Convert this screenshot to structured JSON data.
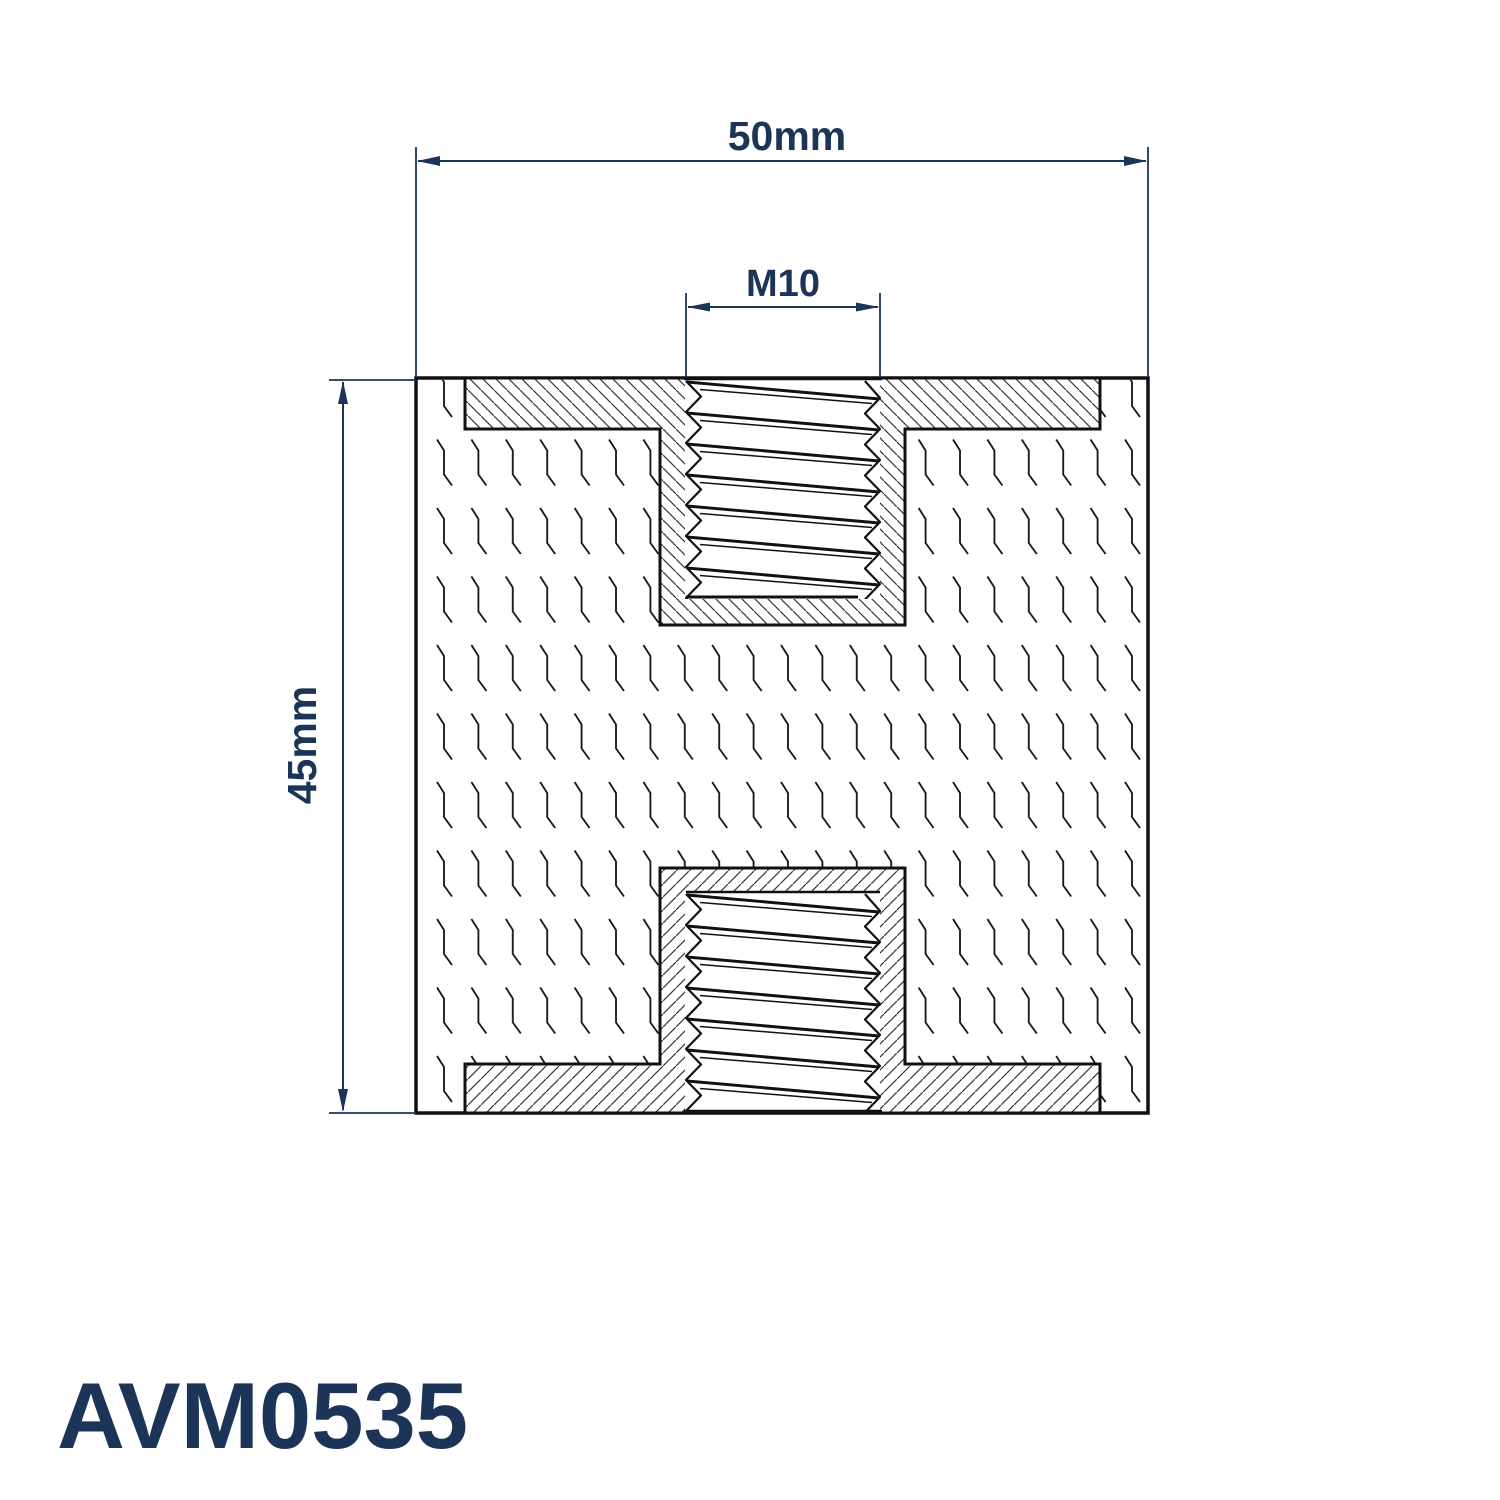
{
  "drawing": {
    "part_number": "AVM0535",
    "dimensions": {
      "width": {
        "label": "50mm"
      },
      "thread": {
        "label": "M10"
      },
      "height": {
        "label": "45mm"
      }
    },
    "colors": {
      "dimension_navy": "#1c3457",
      "line_black": "#111111",
      "background": "#ffffff"
    }
  }
}
